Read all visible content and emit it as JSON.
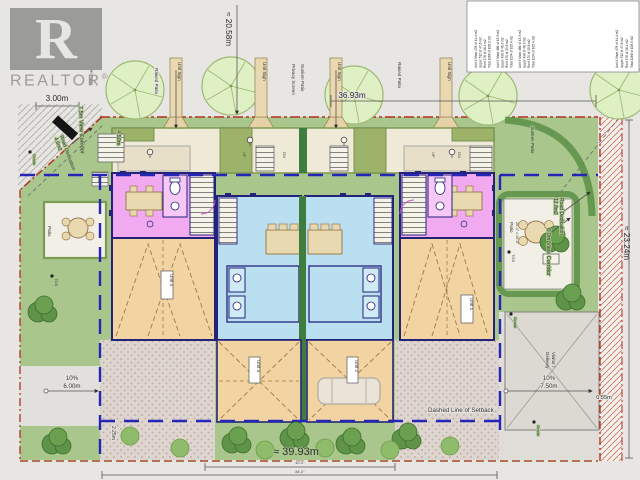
{
  "logo": {
    "letter": "R",
    "wordmark": "REALTOR",
    "registered": "®"
  },
  "area_table": {
    "lines": [
      "Unit 1  Main 478 sf  44.4 m2",
      "Upper 512 sf  47.6 m2",
      "Roof 176 sf  16.4 m2",
      "Total 1166 sf  108.3 m2",
      "Unit 2  Main 466 sf  43.3 m2",
      "Upper 498 sf  46.3 m2",
      "Roof 170 sf  15.8 m2",
      "Total 1134 sf  105.4 m2",
      "Unit 3  Main 466 sf  43.3 m2",
      "Upper 498 sf  46.3 m2",
      "Roof 170 sf  15.8 m2",
      "Total 1134 sf  105.4 m2",
      "Unit 4  Main 478 sf  44.4 m2",
      "Upper 512 sf  47.6 m2",
      "Roof 176 sf  16.4 m2",
      "Total 1166 sf  108.3 m2"
    ]
  },
  "dimensions": {
    "top_left": "3.00m",
    "top_width": "≈ 20.58m",
    "top_right_width": "36.93m",
    "right_height": "≈ 23.24m",
    "bottom_width": "≈ 39.93m",
    "left_lane_pct": "10%",
    "left_lane": "6.00m",
    "right_lane_pct": "10%",
    "right_lane": "7.50m",
    "right_offset": "0.55m",
    "sidewalk": "2.25m",
    "front_yard": "4.50m",
    "road_inner": "40'-0\"",
    "road_outer": "84'-0\""
  },
  "annotations": {
    "view_corridor_left": "7.5m View Corridor",
    "road_dedication": "Road Dedication",
    "road_dedication_left_area": "4.5m2",
    "road_dedication_right_area": "12.8m2",
    "view_corridor_right": "6.0m View Corridor",
    "setback_note": "Dashed Line of Setback",
    "unit_sign": "Unit Sign",
    "raised_patio": "Raised Patio",
    "privacy_screen": "Privacy Screen",
    "sunken_patio": "Sunken Patio",
    "up": "UP",
    "dn": "DN",
    "patio": "Patio",
    "patio_size": "20'-4\" x 10'-0\"",
    "tos": "TOS",
    "grade": "Grade",
    "visitor_line1": "Visitor /",
    "visitor_line2": "Delivery"
  },
  "units": {
    "u1": "Unit 1",
    "u2": "Unit 2",
    "u3": "Unit 3",
    "u4": "Unit 4"
  }
}
